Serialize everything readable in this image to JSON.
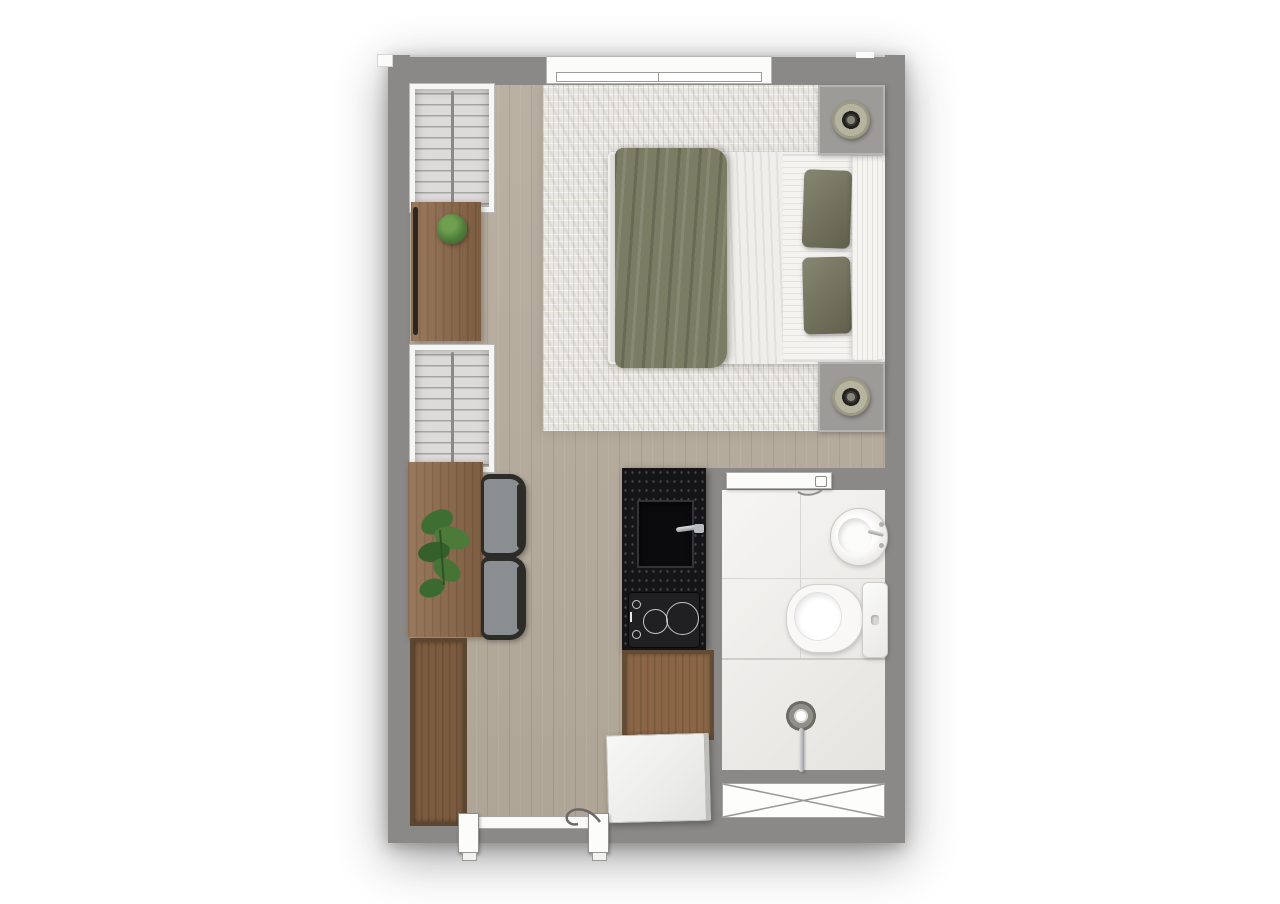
{
  "page": {
    "type": "apartment-floor-plan",
    "description": "Top-down rendered floor plan of a studio apartment, no text labels visible",
    "background": "#ffffff"
  },
  "palette": {
    "wall": "#8b8987",
    "floor": "#b6ac9d",
    "rug": "#e9e7e2",
    "bathFloor": "#edebe7",
    "bathLine": "#d9d7d3",
    "wood": "#8e6a4b",
    "cabinetWood": "#8a6647",
    "counter": "#151517",
    "olive": "#7b7c64",
    "oliveDark": "#72735a",
    "chairSeat": "#8b8e90",
    "chairFrame": "#2e2c29",
    "plant": "#4c7a39",
    "nightstand": "#9d9b98",
    "lampRing": "#b6b39e",
    "steel": "#b9bcbf"
  },
  "rooms": [
    {
      "name": "sleeping-area",
      "features": [
        "double-bed",
        "area-rug",
        "nightstand-left",
        "nightstand-right",
        "table-lamp-left",
        "table-lamp-right"
      ]
    },
    {
      "name": "living-kitchen",
      "features": [
        "wardrobe-upper",
        "console-with-plant",
        "wardrobe-lower",
        "desk-with-monstera",
        "chair-1",
        "chair-2",
        "tall-cabinet",
        "black-countertop-with-sink",
        "two-burner-cooktop",
        "wood-counter",
        "refrigerator"
      ]
    },
    {
      "name": "bathroom",
      "features": [
        "round-washbasin",
        "toilet",
        "cistern-shelf",
        "walk-in-shower-with-drain",
        "service-shaft"
      ]
    }
  ],
  "openings": {
    "window_top": 1,
    "bathroom_sliding_door": 1,
    "entry_door_bottom": 1
  },
  "counts": {
    "wardrobes": 2,
    "chairs": 2,
    "plants": 2,
    "lamps": 2,
    "cooktop_burners": 2
  }
}
